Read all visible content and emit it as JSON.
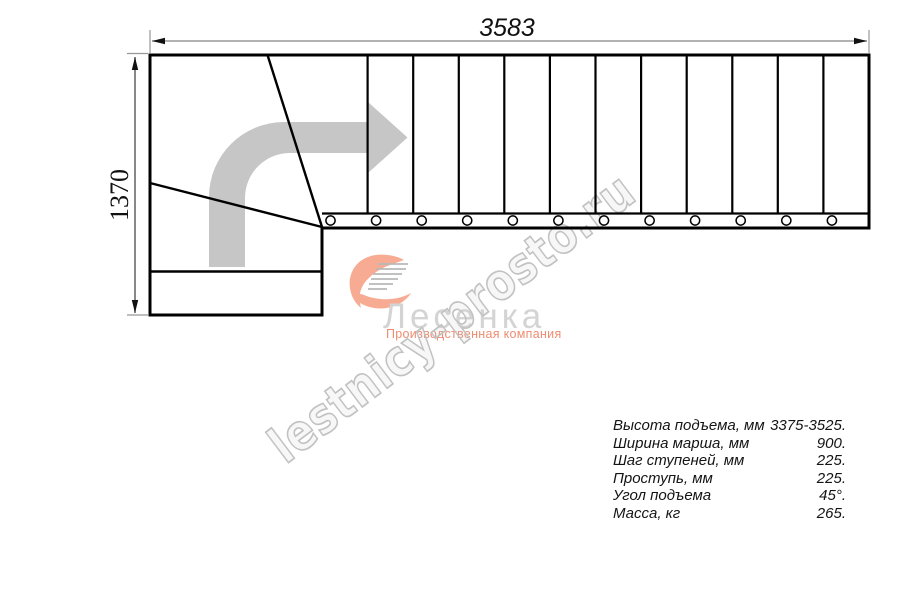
{
  "drawing": {
    "width_dim_label": "3583",
    "height_dim_label": "1370",
    "tread_count": 12
  },
  "branding": {
    "company": "Лесенка",
    "tagline": "Производственная компания",
    "watermark": "lestnicy-prosto.ru"
  },
  "specs": {
    "rows": [
      {
        "label": "Высота подъема, мм",
        "value": "3375-3525."
      },
      {
        "label": "Ширина марша, мм",
        "value": "900."
      },
      {
        "label": "Шаг ступеней, мм",
        "value": "225."
      },
      {
        "label": "Проступь, мм",
        "value": "225."
      },
      {
        "label": "Угол подъема",
        "value": "45°."
      },
      {
        "label": "Масса, кг",
        "value": "265."
      }
    ]
  },
  "colors": {
    "outline": "#000000",
    "dimension_line": "#989898",
    "direction_arrow": "#c6c6c6",
    "watermark": "#c2c2c2",
    "logo_text": "#d4d4d4",
    "accent_salmon": "#ee8c72"
  }
}
